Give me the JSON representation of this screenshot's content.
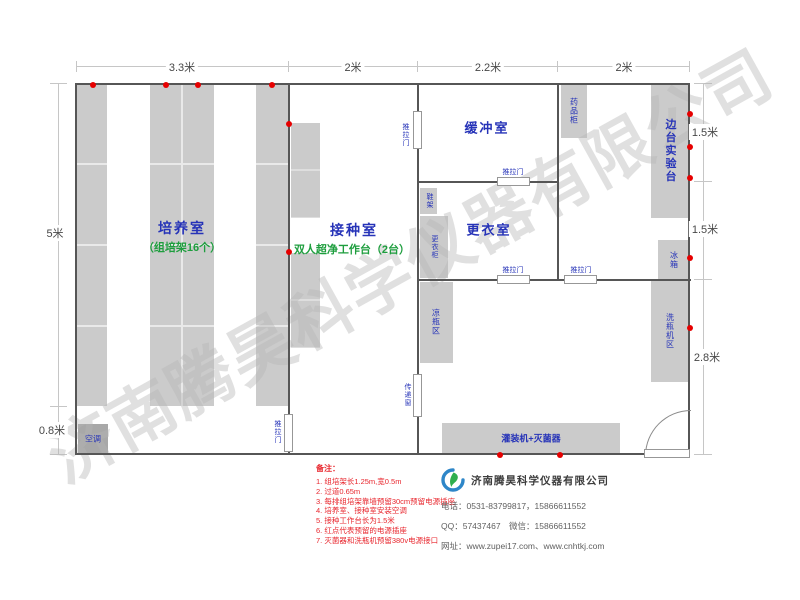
{
  "watermark": "济南腾昊科学仪器有限公司",
  "dimensions": {
    "top": [
      "3.3米",
      "2米",
      "2.2米",
      "2米"
    ],
    "left_main": "5米",
    "left_aisle": "0.8米",
    "right": [
      "1.5米",
      "1.5米",
      "2.8米"
    ]
  },
  "rooms": {
    "culture": {
      "name": "培养室",
      "sub": "（组培架16个）"
    },
    "inoculation": {
      "name": "接种室",
      "sub": "双人超净工作台（2台）"
    },
    "buffer": {
      "name": "缓冲室"
    },
    "changing": {
      "name": "更衣室"
    }
  },
  "labels": {
    "sliding_door": "推拉门",
    "transfer_window": "传递窗",
    "medicine_cabinet": "药品柜",
    "side_bench": "边台实验台",
    "fridge": "冰箱",
    "washing_area": "洗瓶机区",
    "shoe_rack": "鞋架",
    "wardrobe": "更衣柜",
    "cooling_area": "凉瓶区",
    "filling_sterilizer": "灌装机+灭菌器",
    "air_conditioner": "空调"
  },
  "notes": {
    "title": "备注：",
    "items": [
      "1. 组培架长1.25m,宽0.5m",
      "2. 过道0.65m",
      "3. 每排组培架靠墙预留30cm预留电源插座",
      "4. 培养室、接种室安装空调",
      "5. 接种工作台长为1.5米",
      "6. 红点代表预留的电源插座",
      "7. 灭菌器和洗瓶机预留380v电源接口"
    ]
  },
  "company": {
    "name": "济南腾昊科学仪器有限公司",
    "phone": "电话：0531-83799817，15866611552",
    "qq": "QQ：57437467　微信：15866611552",
    "website": "网址：www.zupei17.com、www.cnhtkj.com"
  },
  "colors": {
    "room_label": "#2633b8",
    "sub_label": "#1e9e3e",
    "note_red": "#e8262d",
    "block_gray": "#cbcbcb",
    "dot_red": "#e60000"
  }
}
